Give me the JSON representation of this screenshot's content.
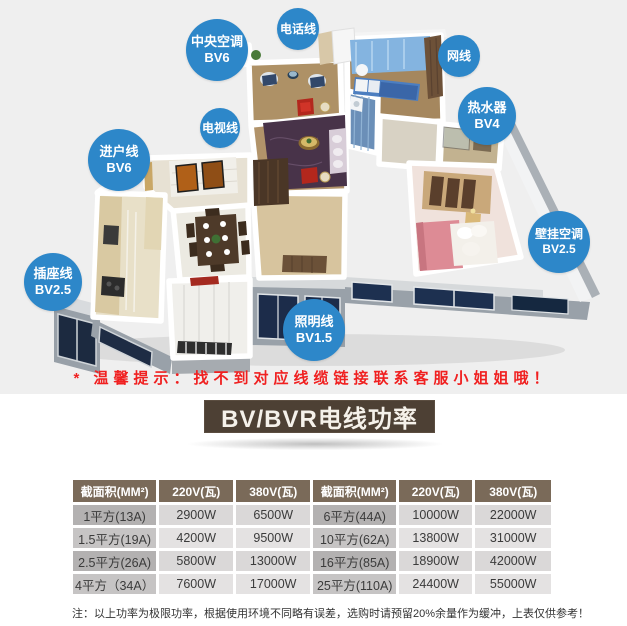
{
  "page": {
    "section_top_bg": "#efefef",
    "accent_blue": "#2d87c9",
    "tip_red": "#f02020",
    "title_brown": "#4d4034",
    "header_brown": "#7a6a59"
  },
  "floorplan": {
    "labels": {
      "central_ac": {
        "line1": "中央空调",
        "line2": "BV6"
      },
      "phone": {
        "line1": "电话线"
      },
      "network": {
        "line1": "网线"
      },
      "heater": {
        "line1": "热水器",
        "line2": "BV4"
      },
      "tv": {
        "line1": "电视线"
      },
      "entry": {
        "line1": "进户线",
        "line2": "BV6"
      },
      "socket": {
        "line1": "插座线",
        "line2": "BV2.5"
      },
      "lighting": {
        "line1": "照明线",
        "line2": "BV1.5"
      },
      "wall_ac": {
        "line1": "壁挂空调",
        "line2": "BV2.5"
      }
    }
  },
  "tip": "* 温馨提示：找不到对应线缆链接联系客服小姐姐哦！",
  "power_table": {
    "title": "BV/BVR电线功率",
    "headers": [
      "截面积(MM²)",
      "220V(瓦)",
      "380V(瓦)",
      "截面积(MM²)",
      "220V(瓦)",
      "380V(瓦)"
    ],
    "rows": [
      [
        "1平方(13A)",
        "2900W",
        "6500W",
        "6平方(44A)",
        "10000W",
        "22000W"
      ],
      [
        "1.5平方(19A)",
        "4200W",
        "9500W",
        "10平方(62A)",
        "13800W",
        "31000W"
      ],
      [
        "2.5平方(26A)",
        "5800W",
        "13000W",
        "16平方(85A)",
        "18900W",
        "42000W"
      ],
      [
        "4平方（34A）",
        "7600W",
        "17000W",
        "25平方(110A)",
        "24400W",
        "55000W"
      ]
    ],
    "note": "注：以上功率为极限功率，根据使用环境不同略有误差，选购时请预留20%余量作为缓冲，上表仅供参考！"
  }
}
